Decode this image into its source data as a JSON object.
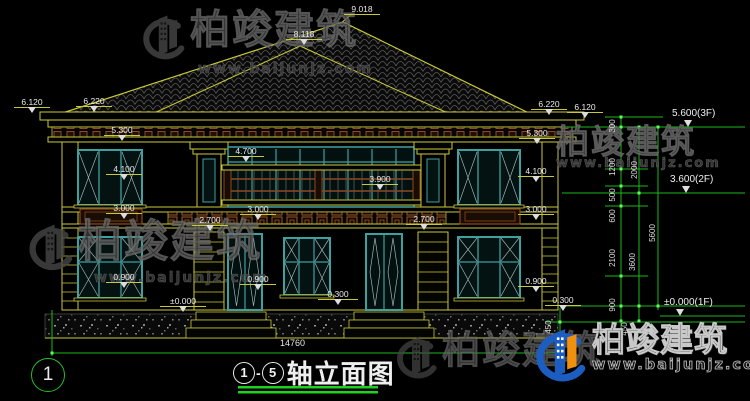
{
  "watermark": {
    "brand": "柏竣建筑",
    "url": "www.baijunjz.com"
  },
  "title": {
    "axis_start": "1",
    "dash": "-",
    "axis_end": "5",
    "name": "轴立面图"
  },
  "axis_bubble": "1",
  "overall_dim": "14760",
  "elevation_labels": [
    {
      "t": "6.120",
      "x": 14,
      "y": 97,
      "w": 36
    },
    {
      "t": "6.220",
      "x": 76,
      "y": 96,
      "w": 36
    },
    {
      "t": "5.300",
      "x": 104,
      "y": 125,
      "w": 36
    },
    {
      "t": "4.100",
      "x": 106,
      "y": 164,
      "w": 36
    },
    {
      "t": "3.000",
      "x": 106,
      "y": 203,
      "w": 36
    },
    {
      "t": "0.900",
      "x": 106,
      "y": 272,
      "w": 36
    },
    {
      "t": "9.018",
      "x": 344,
      "y": 4,
      "w": 36,
      "noTri": true
    },
    {
      "t": "8.118",
      "x": 286,
      "y": 29,
      "w": 36
    },
    {
      "t": "4.700",
      "x": 228,
      "y": 146,
      "w": 36
    },
    {
      "t": "3.900",
      "x": 362,
      "y": 174,
      "w": 36
    },
    {
      "t": "3.000",
      "x": 240,
      "y": 204,
      "w": 36
    },
    {
      "t": "2.700",
      "x": 192,
      "y": 215,
      "w": 36
    },
    {
      "t": "2.700",
      "x": 406,
      "y": 214,
      "w": 36
    },
    {
      "t": "0.900",
      "x": 240,
      "y": 274,
      "w": 36
    },
    {
      "t": "±0.000",
      "x": 160,
      "y": 296,
      "w": 46
    },
    {
      "t": "0.300",
      "x": 318,
      "y": 289,
      "w": 40
    },
    {
      "t": "5.300",
      "x": 519,
      "y": 128,
      "w": 36
    },
    {
      "t": "6.220",
      "x": 531,
      "y": 99,
      "w": 36
    },
    {
      "t": "6.120",
      "x": 567,
      "y": 102,
      "w": 36
    },
    {
      "t": "4.100",
      "x": 518,
      "y": 166,
      "w": 36
    },
    {
      "t": "3.000",
      "x": 518,
      "y": 204,
      "w": 36
    },
    {
      "t": "0.900",
      "x": 518,
      "y": 276,
      "w": 36
    },
    {
      "t": "0.300",
      "x": 545,
      "y": 295,
      "w": 36
    }
  ],
  "floor_labels": [
    {
      "t": "5.600(3F)",
      "x": 672,
      "y": 108
    },
    {
      "t": "3.600(2F)",
      "x": 670,
      "y": 174
    },
    {
      "t": "±0.000(1F)",
      "x": 664,
      "y": 297
    }
  ],
  "vertical_dims": [
    {
      "t": "300",
      "x": 613,
      "y": 126
    },
    {
      "t": "1200",
      "x": 613,
      "y": 167
    },
    {
      "t": "500",
      "x": 613,
      "y": 195
    },
    {
      "t": "600",
      "x": 613,
      "y": 216
    },
    {
      "t": "2100",
      "x": 613,
      "y": 258
    },
    {
      "t": "900",
      "x": 613,
      "y": 305
    },
    {
      "t": "450",
      "x": 625,
      "y": 329
    },
    {
      "t": "450",
      "x": 549,
      "y": 327
    },
    {
      "t": "2000",
      "x": 635,
      "y": 170
    },
    {
      "t": "3600",
      "x": 633,
      "y": 262
    },
    {
      "t": "5600",
      "x": 653,
      "y": 233
    }
  ]
}
